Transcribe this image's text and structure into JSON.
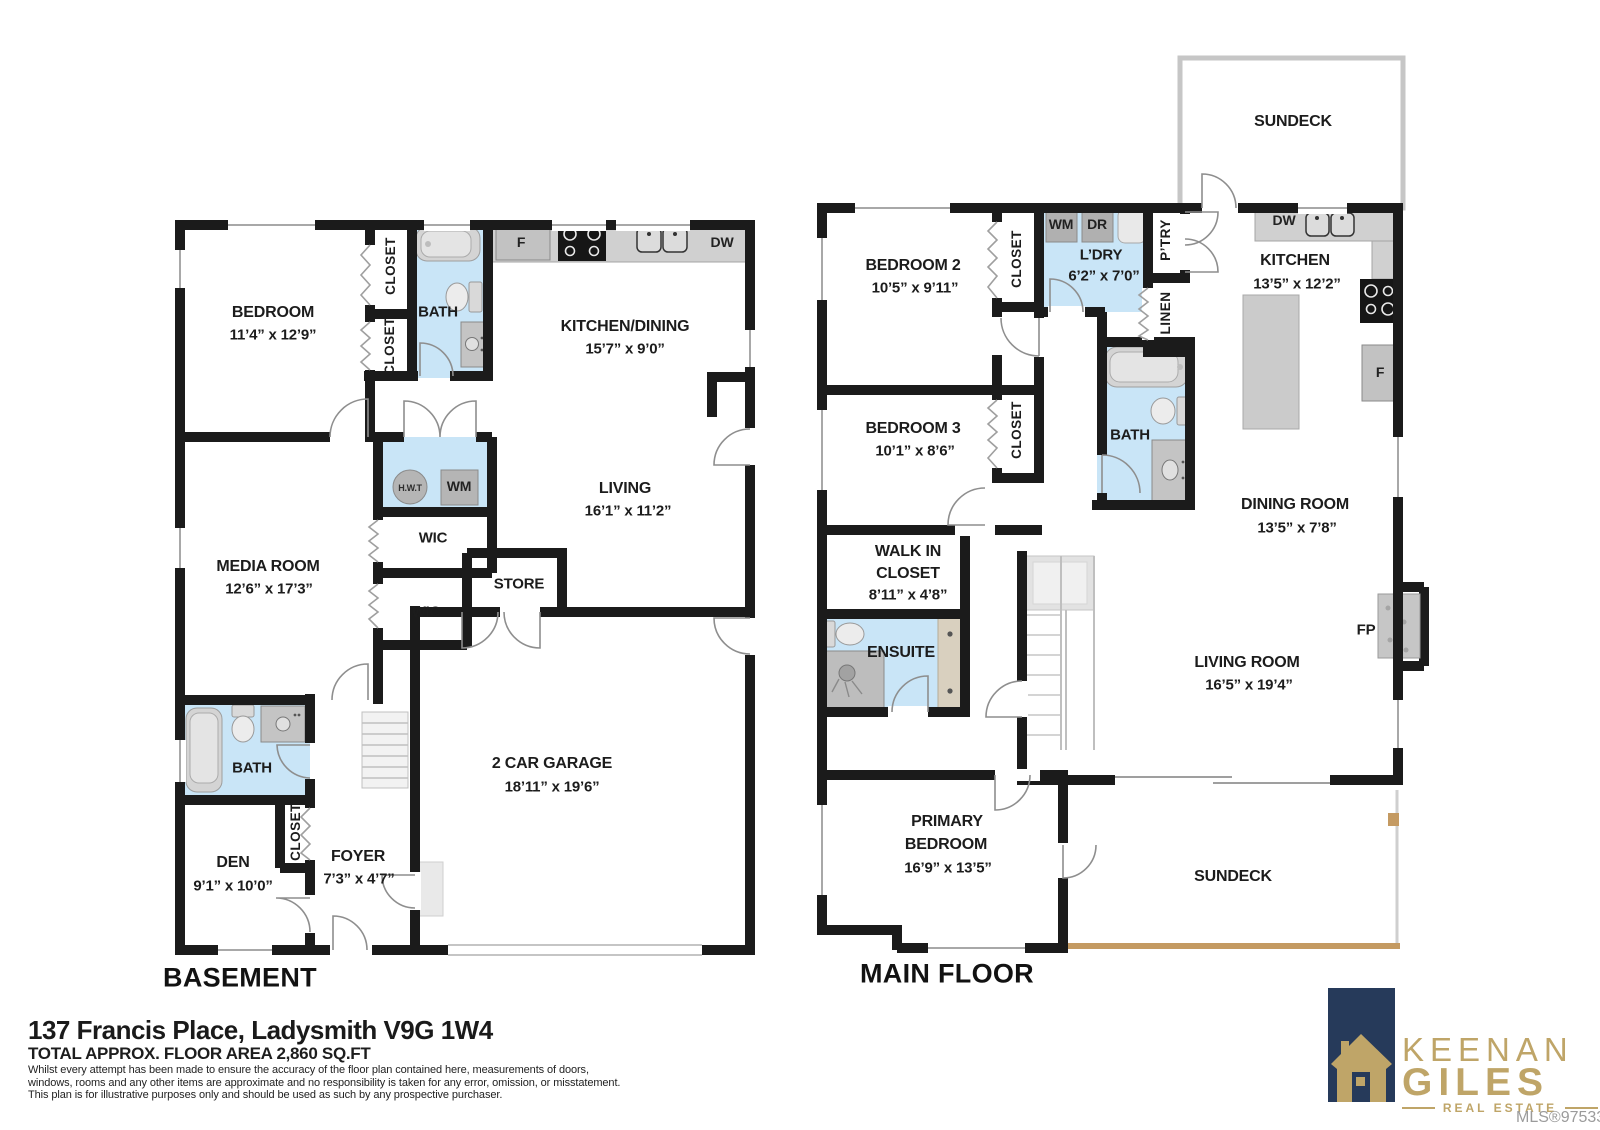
{
  "basement": {
    "title": "BASEMENT",
    "bedroom": {
      "name": "BEDROOM",
      "dims": "11’4” x 12’9”"
    },
    "closet_top": "CLOSET",
    "closet_mid": "CLOSET",
    "bath": "BATH",
    "kitchen_dining": {
      "name": "KITCHEN/DINING",
      "dims": "15’7” x 9’0”"
    },
    "fridge": "F",
    "dishwasher": "DW",
    "living": {
      "name": "LIVING",
      "dims": "16’1” x 11’2”"
    },
    "hot_water_tank": "H.W.T",
    "washer": "WM",
    "wic_upper": "WIC",
    "store": "STORE",
    "wic_lower": "WIC",
    "media": {
      "name": "MEDIA ROOM",
      "dims": "12’6” x 17’3”"
    },
    "bath_lower": "BATH",
    "den_closet": "CLOSET",
    "den": {
      "name": "DEN",
      "dims": "9’1” x 10’0”"
    },
    "foyer": {
      "name": "FOYER",
      "dims": "7’3” x 4’7”"
    },
    "garage": {
      "name": "2 CAR GARAGE",
      "dims": "18’11” x 19’6”"
    }
  },
  "main": {
    "title": "MAIN FLOOR",
    "sundeck_upper": "SUNDECK",
    "sundeck_lower": "SUNDECK",
    "bedroom2": {
      "name": "BEDROOM 2",
      "dims": "10’5” x 9’11”"
    },
    "closet_bed2": "CLOSET",
    "closet_bed3": "CLOSET",
    "washer": "WM",
    "dryer": "DR",
    "laundry": {
      "name": "L’DRY",
      "dims": "6’2” x 7’0”"
    },
    "pantry": "P’TRY",
    "linen": "LINEN",
    "dishwasher": "DW",
    "kitchen": {
      "name": "KITCHEN",
      "dims": "13’5” x 12’2”"
    },
    "fridge": "F",
    "bedroom3": {
      "name": "BEDROOM 3",
      "dims": "10’1” x 8’6”"
    },
    "bath": "BATH",
    "walk_in": {
      "line1": "WALK IN",
      "line2": "CLOSET",
      "dims": "8’11” x 4’8”"
    },
    "ensuite": "ENSUITE",
    "dining": {
      "name": "DINING ROOM",
      "dims": "13’5” x 7’8”"
    },
    "fireplace": "FP",
    "living": {
      "name": "LIVING ROOM",
      "dims": "16’5” x 19’4”"
    },
    "primary": {
      "line1": "PRIMARY",
      "line2": "BEDROOM",
      "dims": "16’9” x 13’5”"
    }
  },
  "footer": {
    "address": "137 Francis Place, Ladysmith V9G 1W4",
    "area": "TOTAL APPROX. FLOOR AREA 2,860 SQ.FT",
    "disclaimer1": "Whilst every attempt has been made to ensure the accuracy of the floor plan contained here, measurements of doors,",
    "disclaimer2": "windows, rooms and any other items are approximate and no responsibility is taken for any error, omission, or misstatement.",
    "disclaimer3": "This plan is for illustrative purposes only and should be used as such by any prospective purchaser.",
    "mls": "MLS®975331"
  },
  "branding": {
    "name_first": "KEENAN",
    "name_last": "GILES",
    "tagline": "REAL ESTATE",
    "navy": "#263a5a",
    "gold": "#bfa568"
  },
  "colors": {
    "wall": "#1b1b1b",
    "wet_room_blue": "#c9e5f7",
    "deck_tan": "#c49a62"
  }
}
